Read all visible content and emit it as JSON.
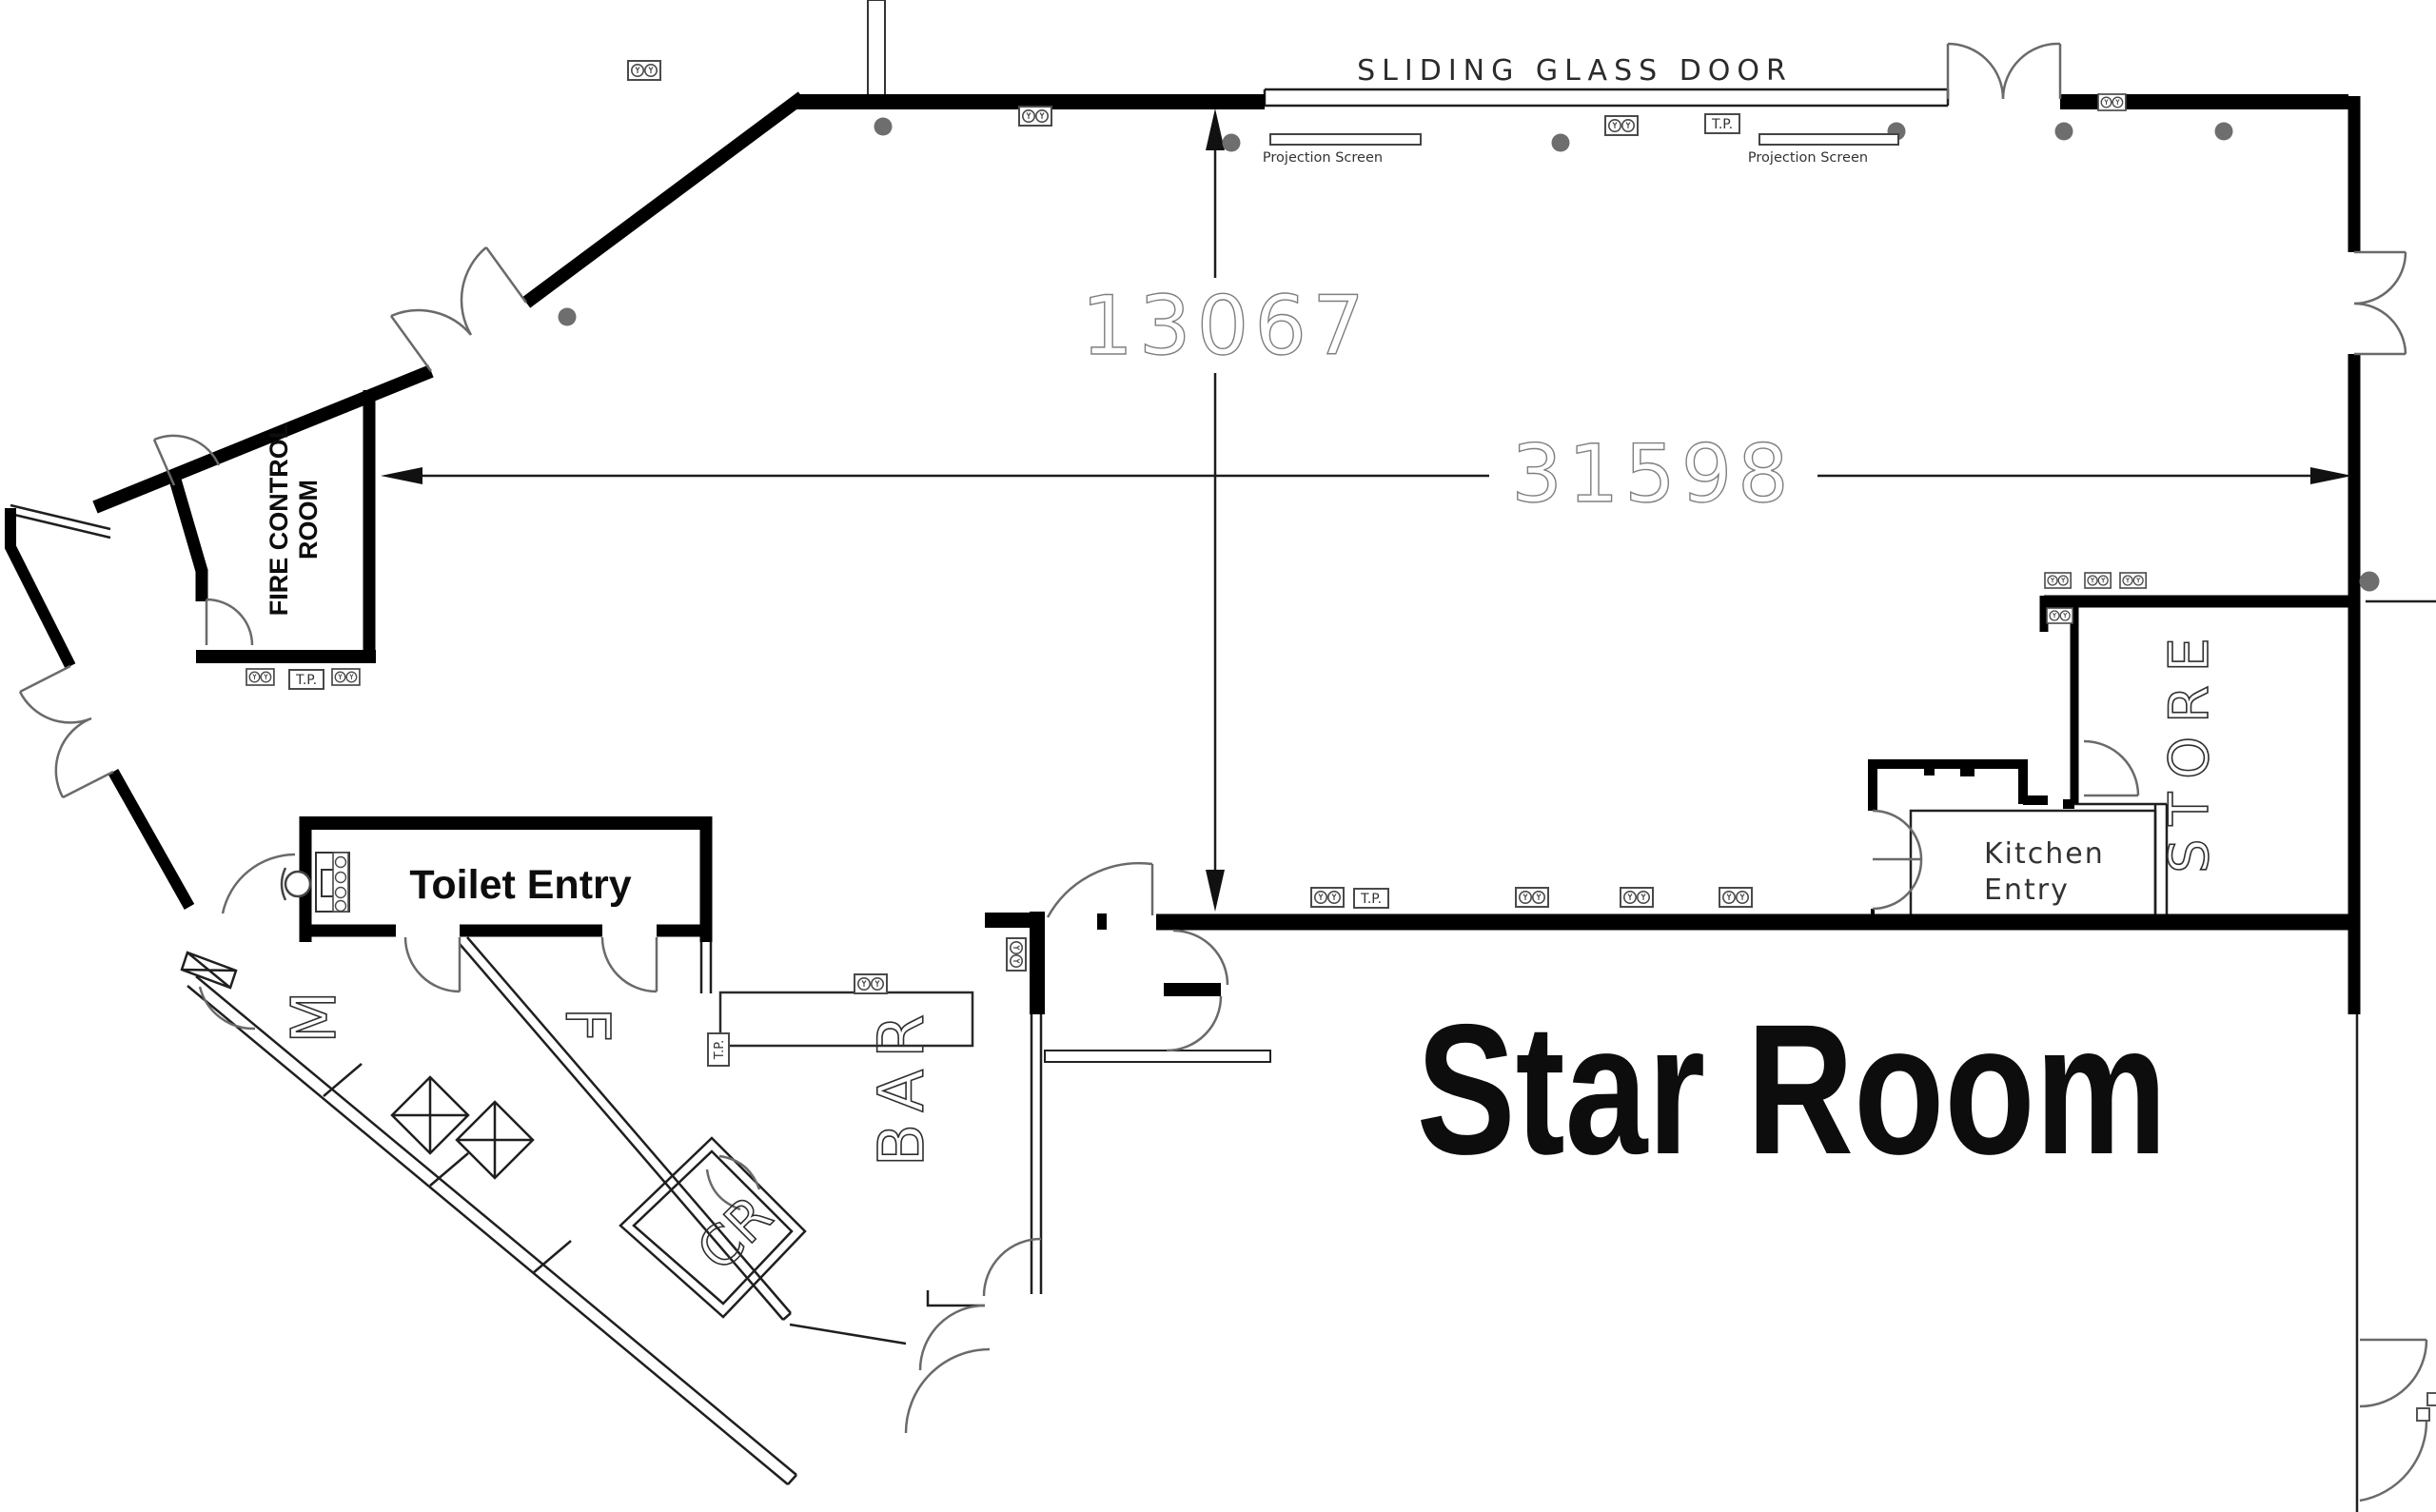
{
  "plan": {
    "main_room_label": "Star Room",
    "labels": {
      "sliding_glass_door": "SLIDING GLASS DOOR",
      "projection_screen": "Projection Screen",
      "telephone_point": "T.P.",
      "toilet_entry": "Toilet Entry",
      "fire_control_line1": "FIRE CONTROL",
      "fire_control_line2": "ROOM",
      "kitchen_entry_line1": "Kitchen",
      "kitchen_entry_line2": "Entry",
      "store": "STORE",
      "bar": "BAR",
      "cloak_room": "CR",
      "male_toilet": "M",
      "female_toilet": "F"
    },
    "dimensions": {
      "overall_width": "31598",
      "room_depth": "13067"
    },
    "colors": {
      "wall": "#000000",
      "door_arc": "#6a6a6a",
      "dimension_text": "#7f7f7f",
      "downlight_dot": "#6e6e6e",
      "symbol_outline": "#4a4a4a"
    }
  }
}
